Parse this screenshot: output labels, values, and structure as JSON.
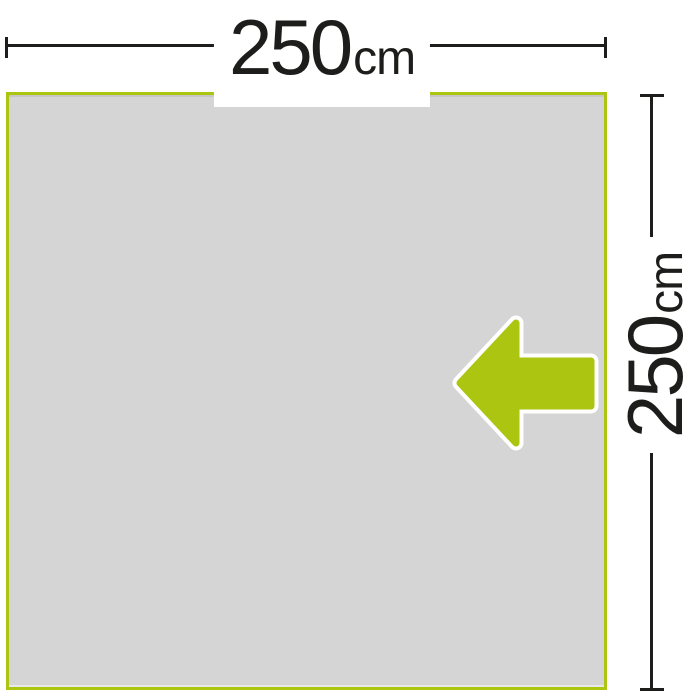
{
  "diagram": {
    "type": "product-dimension-diagram",
    "panel": {
      "shape": "square",
      "fill_color": "#d4d5d4",
      "border_color": "#abc510"
    },
    "width_dimension": {
      "value": "250",
      "unit": "cm"
    },
    "height_dimension": {
      "value": "250",
      "unit": "cm"
    },
    "arrow": {
      "icon": "left-arrow-icon",
      "direction": "left",
      "fill_color": "#abc510",
      "outline_color": "#ffffff"
    },
    "colors": {
      "accent_green": "#abc510",
      "panel_gray": "#d4d5d4",
      "line_dark": "#1d1d1b",
      "background": "#ffffff"
    }
  }
}
